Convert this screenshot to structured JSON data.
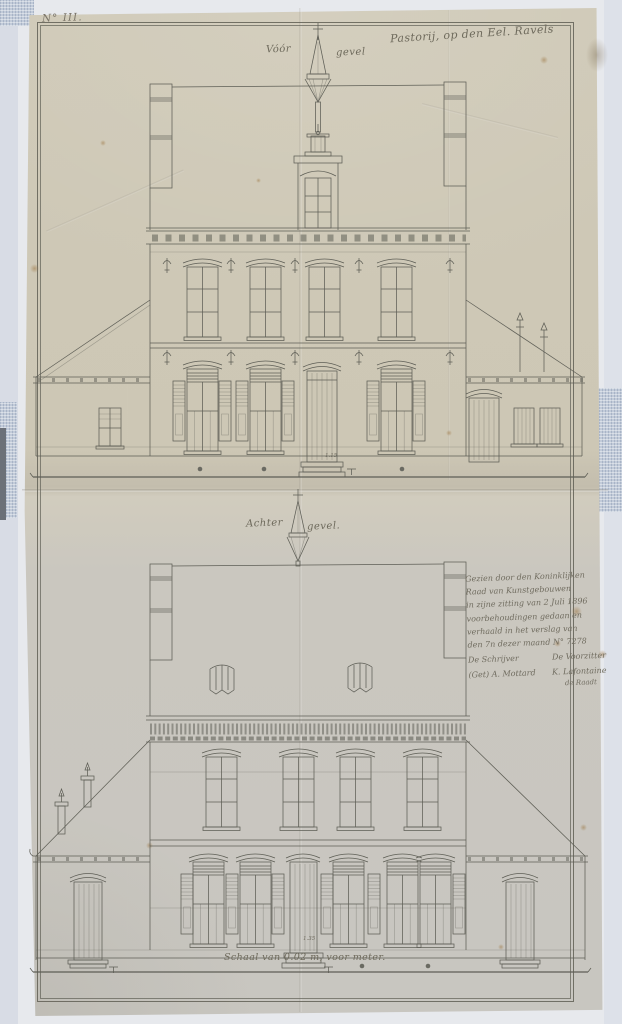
{
  "document": {
    "plate_number": "N° III.",
    "title": "Pastorij, op den Eel. Ravels",
    "front_elevation": {
      "label_left": "Vóór",
      "label_right": "gevel",
      "door_dimension": "1.15"
    },
    "back_elevation": {
      "label_left": "Achter",
      "label_right": "gevel.",
      "door_dimension": "1.35"
    },
    "scale_note": "Schaal van 0.02 m, voor meter.",
    "approval_note": {
      "lines": [
        "Gezien door den Koninklijken",
        "Raad van Kunstgebouwen",
        "in zijne zitting van 2 Juli 1896",
        "voorbehoudingen gedaan en",
        "verhaald in het verslag van",
        "den 7n dezer maand N° 7278"
      ],
      "left_role": "De Schrijver",
      "right_role": "De Voorzitter",
      "left_signature": "(Get) A. Mottard",
      "right_signature": "K. Lafontaine",
      "right_signature_sub": "de Raadt"
    },
    "colors": {
      "paper": "#cdc7b6",
      "paper_lower": "#c8c6c0",
      "ink": "#5e5e56",
      "handwriting": "#6e6a5c",
      "backing_fabric": "#c2cbd9",
      "background": "#e7e9ed"
    }
  }
}
